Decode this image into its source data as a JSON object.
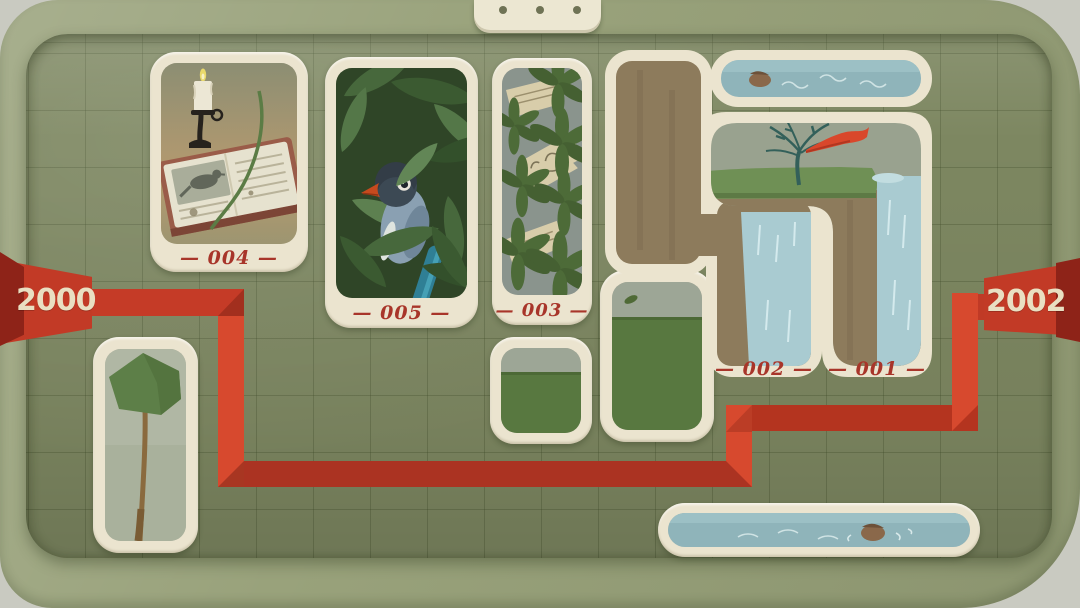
{
  "timeline": {
    "left_year": "2000",
    "right_year": "2002"
  },
  "tiles": {
    "journal": {
      "number": "004",
      "label": "— 004 —"
    },
    "bird": {
      "number": "005",
      "label": "— 005 —"
    },
    "letter": {
      "number": "003",
      "label": "— 003 —"
    },
    "waterfall_left": {
      "number": "002",
      "label": "— 002 —"
    },
    "waterfall_right": {
      "number": "001",
      "label": "— 001 —"
    }
  },
  "board": {
    "notch_dot_count": 3
  },
  "colors": {
    "banner_red": "#c23a26",
    "banner_fold": "#8e2318",
    "ribbon_light": "#d7492e",
    "ribbon_dark": "#ab3322",
    "card_beige": "#ebe4cf",
    "board_green": "#7d8761",
    "frame_sage": "#99a27b",
    "label_red": "#a8352a",
    "water_blue": "#8fb4ba"
  }
}
